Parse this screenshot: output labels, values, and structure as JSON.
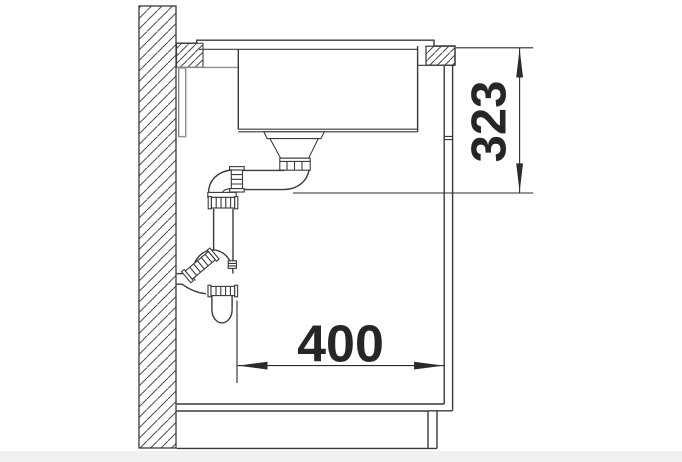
{
  "diagram": {
    "type": "technical-drawing",
    "subject": "Kitchen sink cabinet cross-section (side view) with undermount bowl, drain strainer and wall-outlet trap",
    "dimensions": [
      {
        "id": "depth-below-worktop",
        "value": "323",
        "orientation": "vertical",
        "refers_to": "distance from worktop surface down to bottom of drain outlet"
      },
      {
        "id": "trap-to-front",
        "value": "400",
        "orientation": "horizontal",
        "refers_to": "distance from trap pipe to cabinet front panel"
      }
    ],
    "colors": {
      "line": "#3a3a3a",
      "gray_line": "#8d8d8d",
      "dim": "#2b2b2b",
      "text": "#262626",
      "floor": "#f0f0f1",
      "background": "#ffffff"
    }
  }
}
